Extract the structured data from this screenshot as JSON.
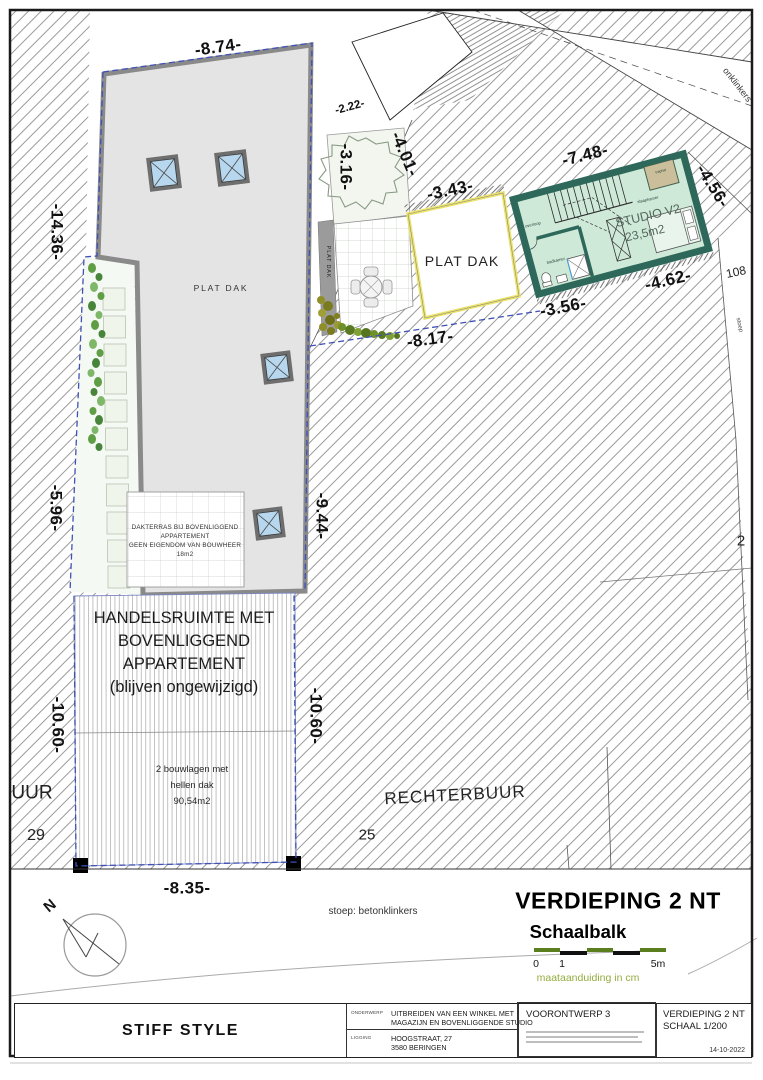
{
  "dims": {
    "d8_74": "-8.74-",
    "d3_16": "-3.16-",
    "d2_22": "-2.22-",
    "d4_01": "-4.01-",
    "d3_43": "-3.43-",
    "d7_48": "-7.48-",
    "d4_56": "-4.56-",
    "d14_36": "-14.36-",
    "d4_62": "-4.62-",
    "d3_56": "-3.56-",
    "d8_17": "-8.17-",
    "d9_44": "-9.44-",
    "d5_96": "-5.96-",
    "d10_60_left": "-10.60-",
    "d10_60_right": "-10.60-",
    "d8_35": "-8.35-"
  },
  "labels": {
    "plat_dak_roof": "PLAT DAK",
    "plat_dak_strip": "PLAT DAK",
    "plat_dak_box": "PLAT DAK",
    "studio_title": "STUDIO V2",
    "studio_area": "23,5m2",
    "overloop": "overloop",
    "slaapkamer": "slaapkamer",
    "badkamer": "badkamer",
    "traphal": "traphal",
    "dakterras_line1": "DAKTERRAS BIJ BOVENLIGGEND",
    "dakterras_line2": "APPARTEMENT",
    "dakterras_line3": "GEEN EIGENDOM VAN BOUWHEER",
    "dakterras_line4": "18m2",
    "handels1": "HANDELSRUIMTE MET",
    "handels2": "BOVENLIGGEND",
    "handels3": "APPARTEMENT",
    "handels4": "(blijven ongewijzigd)",
    "bouwlagen1": "2 bouwlagen met",
    "bouwlagen2": "hellen dak",
    "bouwlagen3": "90,54m2",
    "rechterbuur": "RECHTERBUUR",
    "buur_left": "UUR",
    "num29": "29",
    "num25": "25",
    "num2": "2",
    "num108": "108",
    "stoep_vert": "stoep",
    "onklinkers": "onklinkers",
    "stoep_note": "stoep: betonklinkers",
    "north": "N"
  },
  "footer": {
    "title": "VERDIEPING 2 NT",
    "schaalbalk": "Schaalbalk",
    "scale_0": "0",
    "scale_1": "1",
    "scale_5": "5m",
    "maat": "maataanduiding in cm"
  },
  "titleblock": {
    "firm": "STIFF STYLE",
    "onderwerp_label": "ONDERWERP",
    "onderwerp1": "UITBREIDEN VAN EEN WINKEL MET",
    "onderwerp2": "MAGAZIJN EN BOVENLIGGENDE STUDIO",
    "ligging_label": "LIGGING",
    "ligging1": "HOOGSTRAAT, 27",
    "ligging2": "3580 BERINGEN",
    "fase": "VOORONTWERP 3",
    "blad1": "VERDIEPING 2 NT",
    "blad2": "SCHAAL 1/200",
    "date": "14-10-2022"
  },
  "colors": {
    "studio_wall": "#2d685a",
    "studio_floor": "#cfe9d9",
    "roof_gray": "#e4e4e4",
    "roof_edge": "#8a8a8a",
    "skylight_blue": "#b7d7ee",
    "boundary_blue": "#3f51b5",
    "plat_dak_box_border": "#ece46a",
    "scale_green": "#5b7f1e",
    "maat_green": "#93ad3f",
    "traphal_tan": "#cbbf9b"
  }
}
